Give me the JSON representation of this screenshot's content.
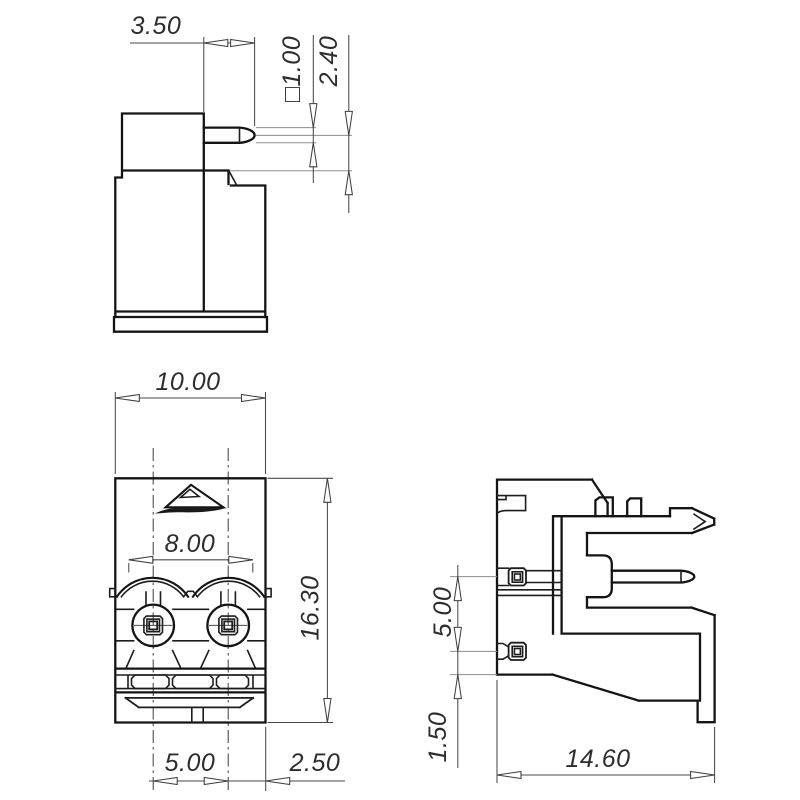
{
  "drawing": {
    "type": "engineering-orthographic-drawing",
    "subject": "2-pole PCB terminal block header, three views with dimensions (mm)",
    "line_color": "#141414",
    "dim_color": "#4a4a4a",
    "background": "#ffffff",
    "views": {
      "side_upper": "upper side elevation with solder pin",
      "front": "front elevation with two clamp screws",
      "side_right": "right side elevation with two pins and mounting foot"
    },
    "dims": {
      "side_upper": {
        "pin_protrusion": "3.50",
        "pin_square_size": "□1.00",
        "pin_center_offset": "2.40"
      },
      "front": {
        "body_width": "10.00",
        "opening_span": "8.00",
        "body_height": "16.30",
        "pin_pitch": "5.00",
        "edge_to_pin": "2.50"
      },
      "side_right": {
        "pin_spacing": "5.00",
        "pin_to_bottom": "1.50",
        "body_depth": "14.60"
      }
    }
  }
}
